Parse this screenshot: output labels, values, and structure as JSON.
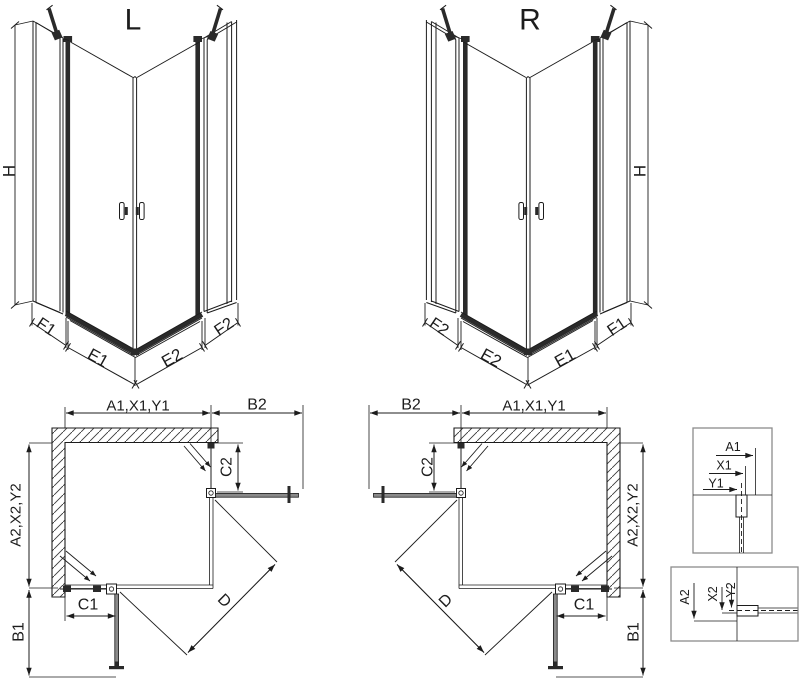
{
  "views": {
    "l": {
      "title": "L",
      "h": "H",
      "f1": "F1",
      "e1": "E1",
      "e2": "E2",
      "f2": "F2"
    },
    "r": {
      "title": "R",
      "h": "H",
      "f1": "F1",
      "e1": "E1",
      "e2": "E2",
      "f2": "F2"
    }
  },
  "plans": {
    "l": {
      "a1": "A1,X1,Y1",
      "b2": "B2",
      "c2": "C2",
      "a2": "A2,X2,Y2",
      "c1": "C1",
      "d": "D",
      "b1": "B1"
    },
    "r": {
      "a1": "A1,X1,Y1",
      "b2": "B2",
      "c2": "C2",
      "a2": "A2,X2,Y2",
      "c1": "C1",
      "d": "D",
      "b1": "B1"
    }
  },
  "details": {
    "glass_top": {
      "a1": "A1",
      "x1": "X1",
      "y1": "Y1"
    },
    "glass_bottom": {
      "a2": "A2",
      "x2": "X2",
      "y2": "Y2"
    }
  },
  "colors": {
    "ink": "#1c1c1c",
    "dark": "#2a2a2a",
    "door": "#8a8a8a",
    "boxb": "#8c8c8c",
    "hatch": "#3a3a3a"
  }
}
